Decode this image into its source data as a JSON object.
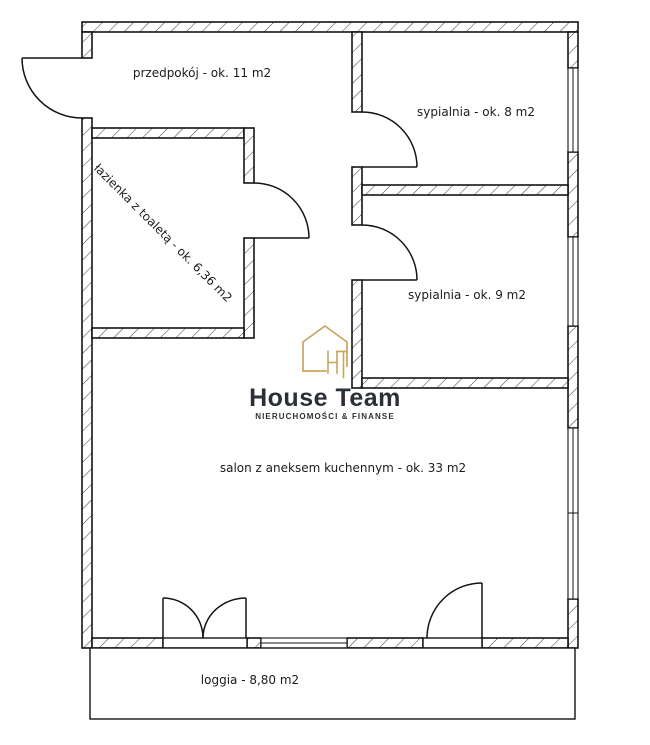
{
  "branding": {
    "logo_letters": "HT",
    "name": "House Team",
    "tagline": "NIERUCHOMOŚCI & FINANSE",
    "gold_color": "#c9a45f",
    "dark_color": "#2b3038"
  },
  "rooms": {
    "przedpokoj": {
      "label": "przedpokój - ok. 11 m2"
    },
    "sypialnia8": {
      "label": "sypialnia - ok. 8 m2"
    },
    "sypialnia9": {
      "label": "sypialnia - ok. 9 m2"
    },
    "lazienka": {
      "label": "łazienka z toaletą - ok. 6,36 m2"
    },
    "salon": {
      "label": "salon z aneksem kuchennym - ok. 33 m2"
    },
    "loggia": {
      "label": "loggia - 8,80 m2"
    }
  }
}
